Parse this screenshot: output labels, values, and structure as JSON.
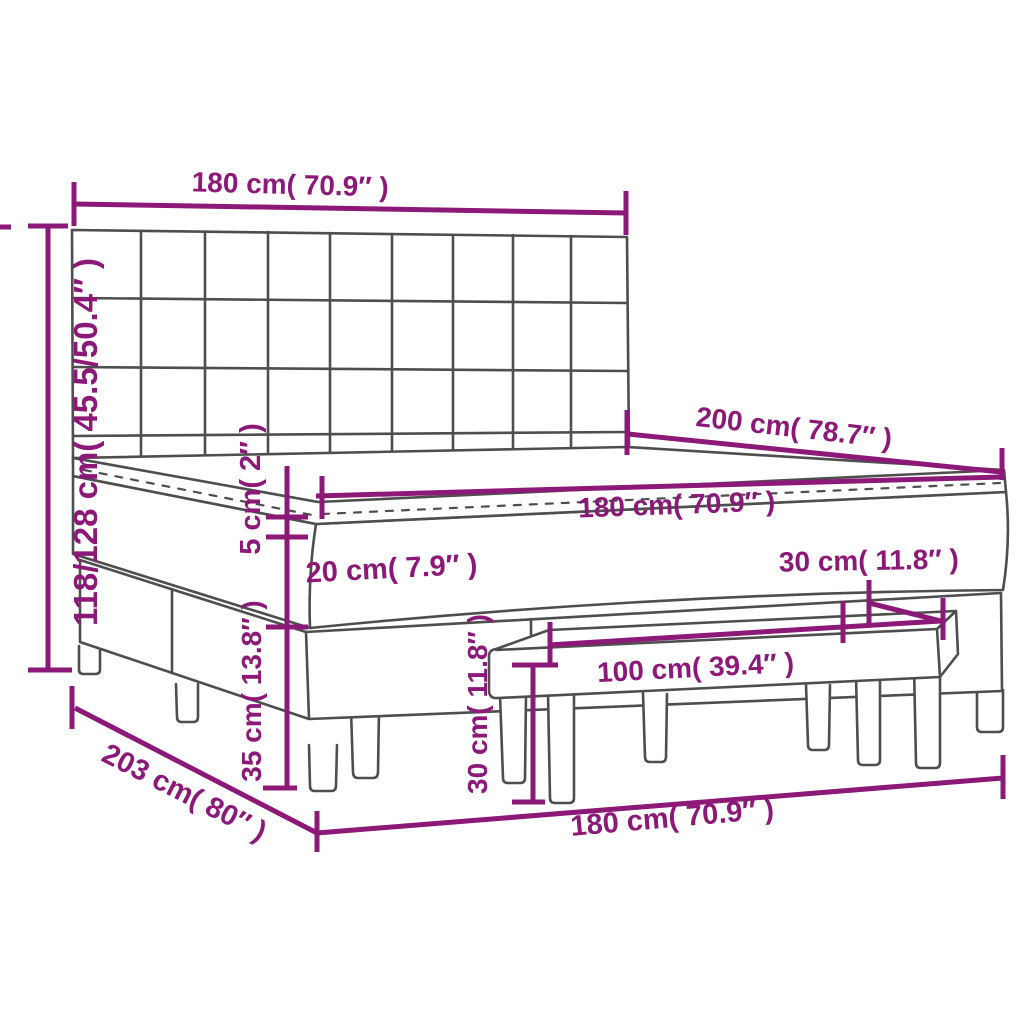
{
  "diagram": {
    "type": "product-dimension-diagram",
    "subject": "box spring bed with square-tufted headboard, mattress topper and bench",
    "colors": {
      "dimension": "#8c1878",
      "outline": "#4e4e4e",
      "background": "#ffffff"
    },
    "dimensions": {
      "headboard_width": "180 cm( 70.9″ )",
      "overall_height": "118/128 cm( 45.5/50.4″ )",
      "mattress_length": "200 cm( 78.7″ )",
      "mattress_width": "180 cm( 70.9″ )",
      "topper_height": "5 cm( 2″ )",
      "mattress_height": "20 cm( 7.9″ )",
      "base_height": "35 cm( 13.8″ )",
      "bench_depth": "30 cm( 11.8″ )",
      "bench_height": "30 cm( 11.8″ )",
      "bench_width": "100 cm( 39.4″ )",
      "bed_width": "180 cm( 70.9″ )",
      "overall_length": "203 cm( 80″ )"
    }
  }
}
